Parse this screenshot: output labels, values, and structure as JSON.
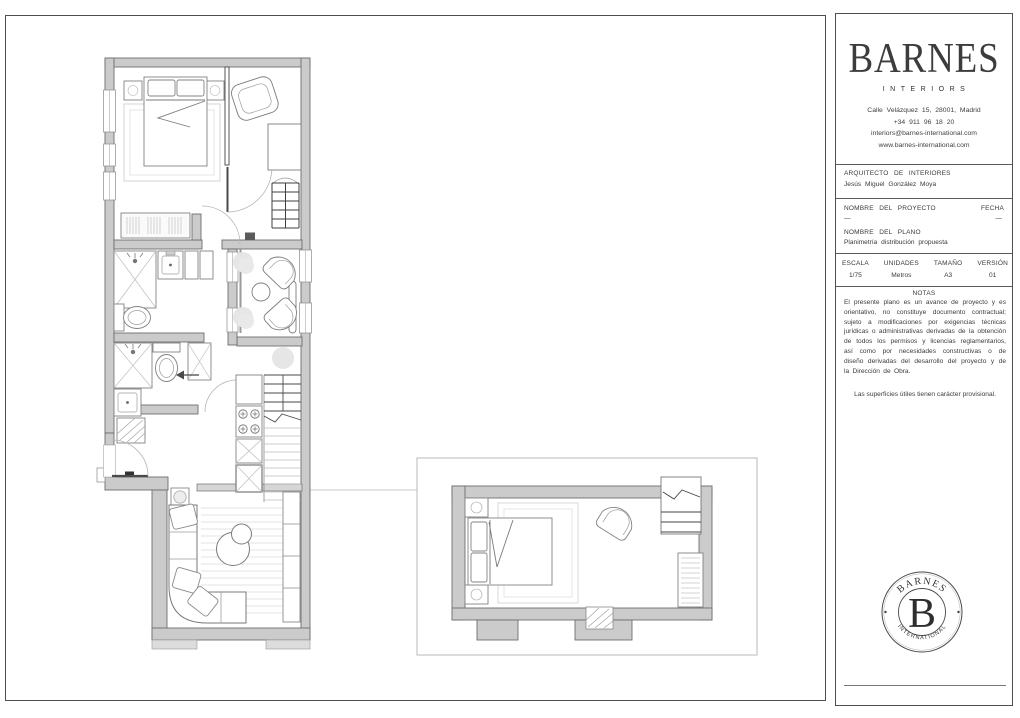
{
  "colors": {
    "wall_fill": "#cbcbcb",
    "wall_stroke": "#6e6e6e",
    "dark_line": "#4a4a4a",
    "light_line": "#c9c9c9",
    "text": "#3c3c3c"
  },
  "brand": {
    "logo": "BARNES",
    "sublogo": "INTERIORS",
    "address_lines": [
      "Calle Velázquez 15, 28001, Madrid",
      "+34 911 96 18 20",
      "interiors@barnes-international.com",
      "www.barnes-international.com"
    ]
  },
  "title_block": {
    "architect_label": "ARQUITECTO DE INTERIORES",
    "architect_name": "Jesús Miguel González Moya",
    "project_label": "NOMBRE DEL PROYECTO",
    "project_value": "—",
    "date_label": "FECHA",
    "date_value": "—",
    "plan_label": "NOMBRE DEL PLANO",
    "plan_value": "Planimetría distribución propuesta",
    "specs": [
      {
        "label": "ESCALA",
        "value": "1/75"
      },
      {
        "label": "UNIDADES",
        "value": "Metros"
      },
      {
        "label": "TAMAÑO",
        "value": "A3"
      },
      {
        "label": "VERSIÓN",
        "value": "01"
      }
    ]
  },
  "notes": {
    "heading": "NOTAS",
    "body": "El presente plano es un avance de proyecto y es orientativo, no constituye documento contractual; sujeto a modificaciones por exigencias técnicas jurídicas o administrativas derivadas de la obtención de todos los permisos y licencias reglamentarios, así como por necesidades constructivas o de diseño derivadas del desarrollo del proyecto y de la Dirección de Obra.",
    "footnote": "Las superficies útiles tienen carácter provisional."
  },
  "seal": {
    "top_text": "BARNES",
    "bottom_text": "INTERNATIONAL",
    "monogram": "B"
  }
}
